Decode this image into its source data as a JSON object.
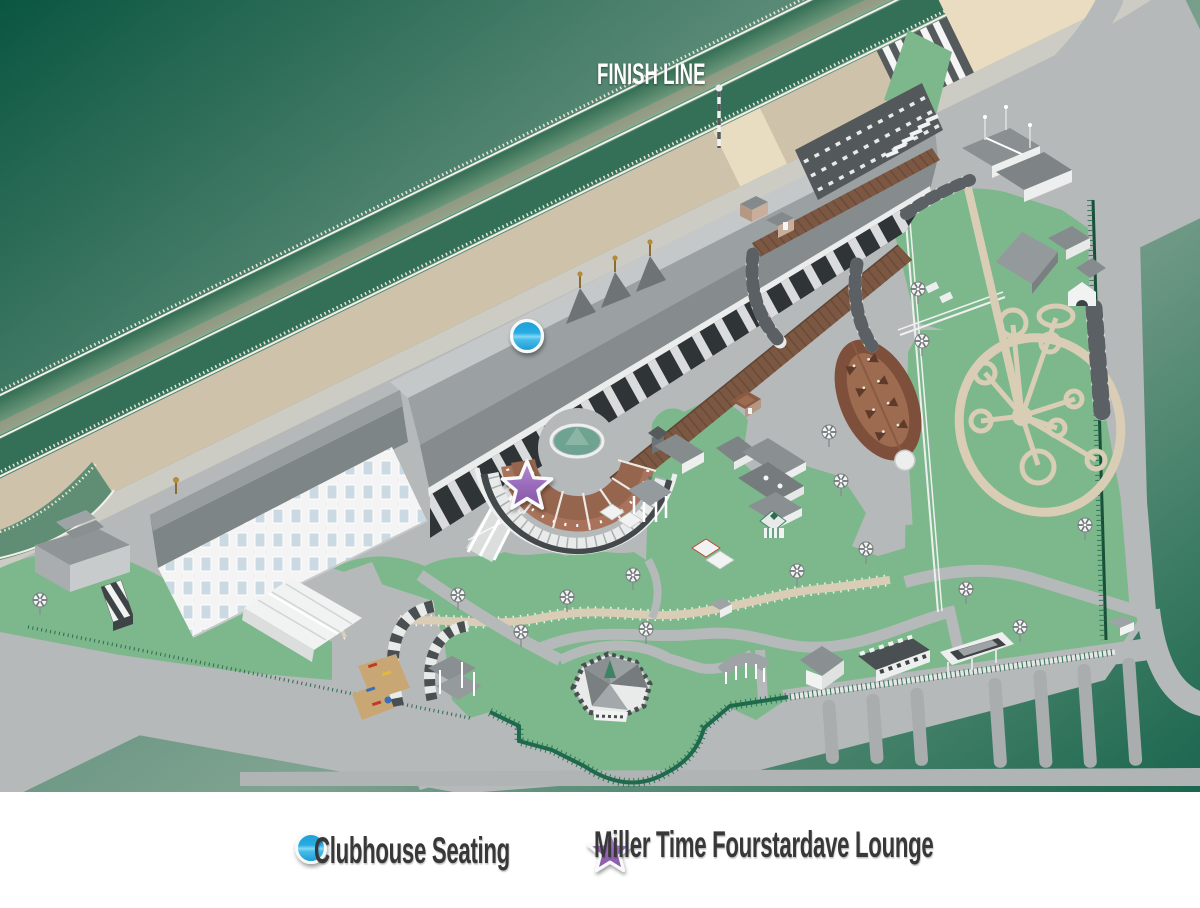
{
  "map": {
    "finish_line_label": "FINISH LINE",
    "colors": {
      "infield_green": "#0B5640",
      "turf_band": "#5F8E75",
      "dirt_track": "#CEC2AA",
      "apron_gray": "#B6B9BA",
      "lawn_green": "#7DB88C",
      "boardwalk_brown": "#7C5742",
      "rotunda_brick": "#96654E"
    },
    "markers": [
      {
        "name": "clubhouse-seating-marker",
        "shape": "circle",
        "color": "#29ABE2",
        "label": "Clubhouse Seating"
      },
      {
        "name": "fourstardave-lounge-marker",
        "shape": "star",
        "color": "#9668B8",
        "label": "Miller Time Fourstardave Lounge"
      }
    ]
  },
  "legend": {
    "items": [
      {
        "label": "Clubhouse Seating",
        "marker": "circle-marker-icon",
        "color": "#29ABE2"
      },
      {
        "label": "Miller Time Fourstardave Lounge",
        "marker": "star-marker-icon",
        "color": "#9668B8"
      }
    ]
  }
}
